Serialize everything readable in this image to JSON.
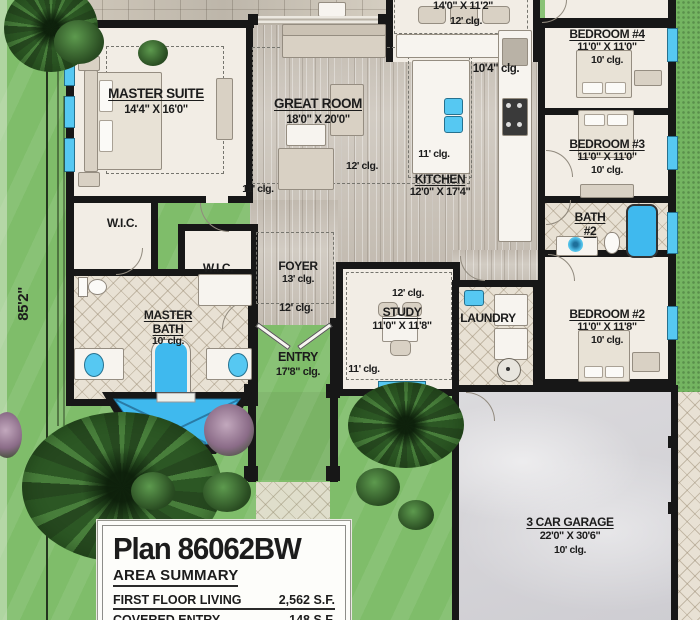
{
  "site": {
    "lot_depth": "85'2\""
  },
  "rooms": {
    "dining": {
      "dims": "14'0\" X 11'2\"",
      "clg": "12' clg."
    },
    "master_suite": {
      "name": "MASTER SUITE",
      "dims": "14'4\" X 16'0\""
    },
    "great_room": {
      "name": "GREAT ROOM",
      "dims": "18'0\" X 20'0\"",
      "clg": "12' clg.",
      "hall_clg": "11' clg."
    },
    "kitchen": {
      "name": "KITCHEN",
      "dims": "12'0\" X 17'4\"",
      "clg": "11' clg.",
      "vault_clg": "10'4\" clg."
    },
    "bedroom4": {
      "name": "BEDROOM #4",
      "dims": "11'0\" X 11'0\"",
      "clg": "10' clg."
    },
    "bedroom3": {
      "name": "BEDROOM #3",
      "dims": "11'0\" X 11'0\"",
      "clg": "10' clg."
    },
    "bath2": {
      "name_line1": "BATH",
      "name_line2": "#2"
    },
    "bedroom2": {
      "name": "BEDROOM #2",
      "dims": "11'0\" X 11'8\"",
      "clg": "10' clg."
    },
    "wic_left": {
      "name": "W.I.C."
    },
    "wic_right": {
      "name": "W.I.C."
    },
    "master_bath": {
      "name_line1": "MASTER",
      "name_line2": "BATH",
      "clg": "10' clg."
    },
    "foyer": {
      "name": "FOYER",
      "clg": "13' clg.",
      "below_clg": "12' clg."
    },
    "entry": {
      "name": "ENTRY",
      "clg": "17'8\" clg."
    },
    "study": {
      "name": "STUDY",
      "dims": "11'0\" X 11'8\"",
      "clg": "12' clg.",
      "hall_clg": "11' clg."
    },
    "laundry": {
      "name": "LAUNDRY"
    },
    "garage": {
      "name": "3 CAR GARAGE",
      "dims": "22'0\" X 30'6\"",
      "clg": "10' clg."
    }
  },
  "title_block": {
    "plan_title": "Plan 86062BW",
    "section_heading": "AREA SUMMARY",
    "rows": [
      {
        "label": "FIRST FLOOR LIVING",
        "value": "2,562 S.F."
      },
      {
        "label": "COVERED ENTRY",
        "value": "148 S.F."
      }
    ]
  },
  "colors": {
    "grass": "#7fbd6a",
    "wall": "#171717",
    "window_blue": "#56c8f2",
    "water_blue": "#3fb9ee",
    "wood_floor": "#ccc5bb",
    "tile_floor": "#e8e1d4",
    "garage_floor": "#d7d6d9"
  }
}
